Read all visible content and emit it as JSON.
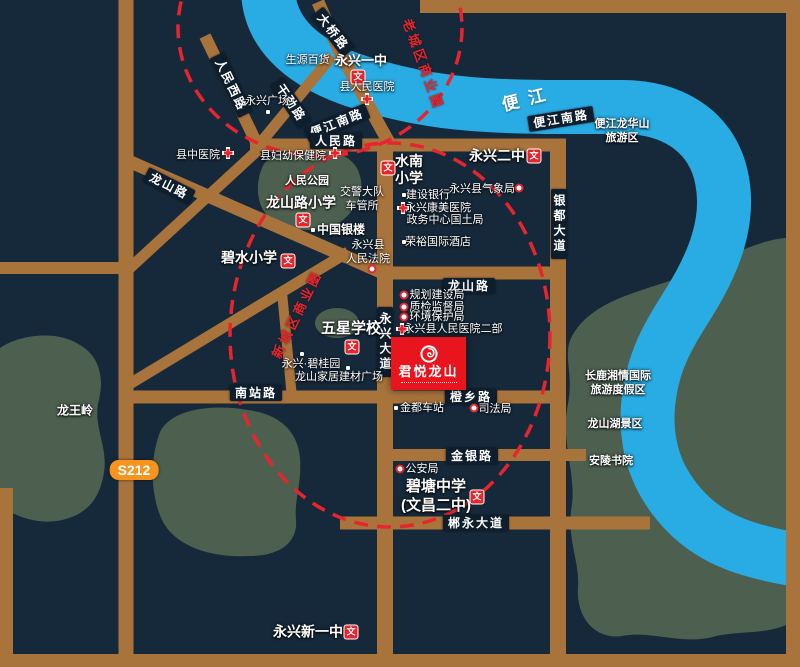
{
  "project": {
    "name": "君悦龙山"
  },
  "river": {
    "name": "便江"
  },
  "highway_badge": {
    "text": "S212"
  },
  "icon_glyphs": {
    "school": "文"
  },
  "colors": {
    "background": "#16293a",
    "road": "#a9743c",
    "water": "#29abe3",
    "green_area": "#4d604f",
    "accent_red": "#e7252e",
    "project_red": "#e8151f",
    "plate_bg": "#0e1e2d",
    "highway_badge_bg": "#f7941e"
  },
  "business_circles": [
    {
      "label": "老城区商业圈",
      "x": 424,
      "y": 64,
      "rot": 70
    },
    {
      "label": "新城区商业圈",
      "x": 296,
      "y": 314,
      "rot": -64
    }
  ],
  "road_plates": [
    {
      "t": "大桥路",
      "x": 333,
      "y": 32,
      "rot": 52
    },
    {
      "t": "人民西路",
      "x": 231,
      "y": 85,
      "rot": 64
    },
    {
      "t": "干劲路",
      "x": 291,
      "y": 103,
      "rot": 56
    },
    {
      "t": "便江南路",
      "x": 337,
      "y": 123,
      "rot": -22
    },
    {
      "t": "便江南路",
      "x": 561,
      "y": 119,
      "rot": -9
    },
    {
      "t": "人民路",
      "x": 336,
      "y": 141,
      "rot": 0
    },
    {
      "t": "龙山路",
      "x": 169,
      "y": 186,
      "rot": 27
    },
    {
      "t": "龙山路",
      "x": 469,
      "y": 286,
      "rot": 0
    },
    {
      "t": "银都大道",
      "x": 559,
      "y": 224,
      "vertical": true
    },
    {
      "t": "永兴大道",
      "x": 385,
      "y": 342,
      "vertical": true
    },
    {
      "t": "南站路",
      "x": 256,
      "y": 393,
      "rot": 0
    },
    {
      "t": "橙乡路",
      "x": 471,
      "y": 397,
      "rot": 0
    },
    {
      "t": "金银路",
      "x": 472,
      "y": 456,
      "rot": 0
    },
    {
      "t": "郴永大道",
      "x": 476,
      "y": 523,
      "rot": 0
    }
  ],
  "pois": [
    {
      "lines": [
        "生源百货 ·"
      ],
      "x": 311,
      "y": 60,
      "size": 11
    },
    {
      "lines": [
        "永兴一中"
      ],
      "x": 361,
      "y": 61,
      "size": 13,
      "bold": true,
      "icons": [
        {
          "t": "school",
          "x": 358,
          "y": 77
        }
      ]
    },
    {
      "lines": [
        "县人民医院"
      ],
      "x": 367,
      "y": 87,
      "size": 11,
      "icons": [
        {
          "t": "cross",
          "x": 367,
          "y": 99
        }
      ]
    },
    {
      "lines": [
        "永兴广场"
      ],
      "x": 267,
      "y": 101,
      "size": 11,
      "icons": [
        {
          "t": "dot",
          "x": 268,
          "y": 112
        }
      ]
    },
    {
      "lines": [
        "县中医院"
      ],
      "x": 198,
      "y": 155,
      "size": 11,
      "icons": [
        {
          "t": "cross",
          "x": 228,
          "y": 153
        }
      ]
    },
    {
      "lines": [
        "县妇幼保健院"
      ],
      "x": 293,
      "y": 156,
      "size": 11,
      "icons": [
        {
          "t": "cross",
          "x": 335,
          "y": 153
        }
      ]
    },
    {
      "lines": [
        "人民公园"
      ],
      "x": 307,
      "y": 181,
      "size": 11,
      "bold": true
    },
    {
      "lines": [
        "龙山路小学"
      ],
      "x": 301,
      "y": 203,
      "size": 14,
      "bold": true,
      "icons": [
        {
          "t": "school",
          "x": 303,
          "y": 220
        }
      ]
    },
    {
      "lines": [
        "交警大队",
        "车管所"
      ],
      "x": 362,
      "y": 199,
      "size": 11,
      "lh": 14
    },
    {
      "lines": [
        "中国银楼"
      ],
      "x": 341,
      "y": 230,
      "size": 12,
      "bold": true,
      "icons": [
        {
          "t": "dot",
          "x": 313,
          "y": 230
        }
      ]
    },
    {
      "lines": [
        "永兴县",
        "人民法院"
      ],
      "x": 368,
      "y": 252,
      "size": 11,
      "lh": 14,
      "icons": [
        {
          "t": "ring",
          "x": 372,
          "y": 269
        }
      ]
    },
    {
      "lines": [
        "碧水小学"
      ],
      "x": 249,
      "y": 258,
      "size": 14,
      "bold": true,
      "icons": [
        {
          "t": "school",
          "x": 288,
          "y": 261
        }
      ]
    },
    {
      "lines": [
        "水南",
        "小学"
      ],
      "x": 409,
      "y": 170,
      "size": 14,
      "bold": true,
      "lh": 17,
      "icons": [
        {
          "t": "school",
          "x": 388,
          "y": 168
        }
      ]
    },
    {
      "lines": [
        "永兴二中"
      ],
      "x": 497,
      "y": 156,
      "size": 14,
      "bold": true,
      "icons": [
        {
          "t": "school",
          "x": 534,
          "y": 156
        }
      ]
    },
    {
      "lines": [
        "永兴县气象局"
      ],
      "x": 482,
      "y": 189,
      "size": 11,
      "icons": [
        {
          "t": "ring",
          "x": 519,
          "y": 188
        }
      ]
    },
    {
      "lines": [
        "建设银行"
      ],
      "x": 428,
      "y": 195,
      "size": 11,
      "icons": [
        {
          "t": "dot",
          "x": 404,
          "y": 195
        }
      ]
    },
    {
      "lines": [
        "永兴康美医院"
      ],
      "x": 438,
      "y": 208,
      "size": 11,
      "icons": [
        {
          "t": "cross",
          "x": 403,
          "y": 208
        }
      ]
    },
    {
      "lines": [
        "政务中心国土局"
      ],
      "x": 445,
      "y": 220,
      "size": 11
    },
    {
      "lines": [
        "荣裕国际酒店"
      ],
      "x": 438,
      "y": 242,
      "size": 11,
      "icons": [
        {
          "t": "dot",
          "x": 404,
          "y": 242
        }
      ]
    },
    {
      "lines": [
        "规划建设局"
      ],
      "x": 437,
      "y": 295,
      "size": 11,
      "icons": [
        {
          "t": "ring",
          "x": 404,
          "y": 295
        }
      ]
    },
    {
      "lines": [
        "质检监督局"
      ],
      "x": 437,
      "y": 307,
      "size": 11,
      "icons": [
        {
          "t": "ring",
          "x": 404,
          "y": 307
        }
      ]
    },
    {
      "lines": [
        "环境保护局"
      ],
      "x": 437,
      "y": 317,
      "size": 11,
      "icons": [
        {
          "t": "ring",
          "x": 404,
          "y": 317
        }
      ]
    },
    {
      "lines": [
        "永兴县人民医院二部"
      ],
      "x": 453,
      "y": 329,
      "size": 11,
      "icons": [
        {
          "t": "cross",
          "x": 402,
          "y": 329
        }
      ]
    },
    {
      "lines": [
        "五星学校"
      ],
      "x": 351,
      "y": 329,
      "size": 15,
      "bold": true,
      "icons": [
        {
          "t": "school",
          "x": 352,
          "y": 347
        }
      ]
    },
    {
      "lines": [
        "永兴·碧桂园"
      ],
      "x": 311,
      "y": 364,
      "size": 11,
      "icons": [
        {
          "t": "dot",
          "x": 302,
          "y": 354
        },
        {
          "t": "dot",
          "x": 348,
          "y": 368
        }
      ]
    },
    {
      "lines": [
        "龙山家居建材广场"
      ],
      "x": 339,
      "y": 377,
      "size": 11
    },
    {
      "lines": [
        "金都车站"
      ],
      "x": 422,
      "y": 408,
      "size": 11,
      "icons": [
        {
          "t": "dot",
          "x": 396,
          "y": 408
        }
      ]
    },
    {
      "lines": [
        "司法局"
      ],
      "x": 495,
      "y": 409,
      "size": 11,
      "icons": [
        {
          "t": "ring",
          "x": 474,
          "y": 408
        }
      ]
    },
    {
      "lines": [
        "公安局"
      ],
      "x": 422,
      "y": 469,
      "size": 11,
      "icons": [
        {
          "t": "ring",
          "x": 400,
          "y": 469
        }
      ]
    },
    {
      "lines": [
        "碧塘中学",
        "(文昌二中)"
      ],
      "x": 436,
      "y": 496,
      "size": 15,
      "bold": true,
      "lh": 19,
      "icons": [
        {
          "t": "school",
          "x": 477,
          "y": 497
        }
      ]
    },
    {
      "lines": [
        "永兴新一中"
      ],
      "x": 308,
      "y": 632,
      "size": 14,
      "bold": true,
      "icons": [
        {
          "t": "school",
          "x": 351,
          "y": 632
        }
      ]
    },
    {
      "lines": [
        "龙王岭"
      ],
      "x": 75,
      "y": 411,
      "size": 12,
      "bold": true
    },
    {
      "lines": [
        "便江龙华山",
        "旅游区"
      ],
      "x": 622,
      "y": 131,
      "size": 11,
      "bold": true,
      "lh": 14
    },
    {
      "lines": [
        "长鹿湘情国际",
        "旅游度假区"
      ],
      "x": 618,
      "y": 383,
      "size": 11,
      "bold": true,
      "lh": 14
    },
    {
      "lines": [
        "龙山湖景区"
      ],
      "x": 615,
      "y": 424,
      "size": 11,
      "bold": true
    },
    {
      "lines": [
        "安陵书院"
      ],
      "x": 611,
      "y": 461,
      "size": 11,
      "bold": true
    }
  ]
}
